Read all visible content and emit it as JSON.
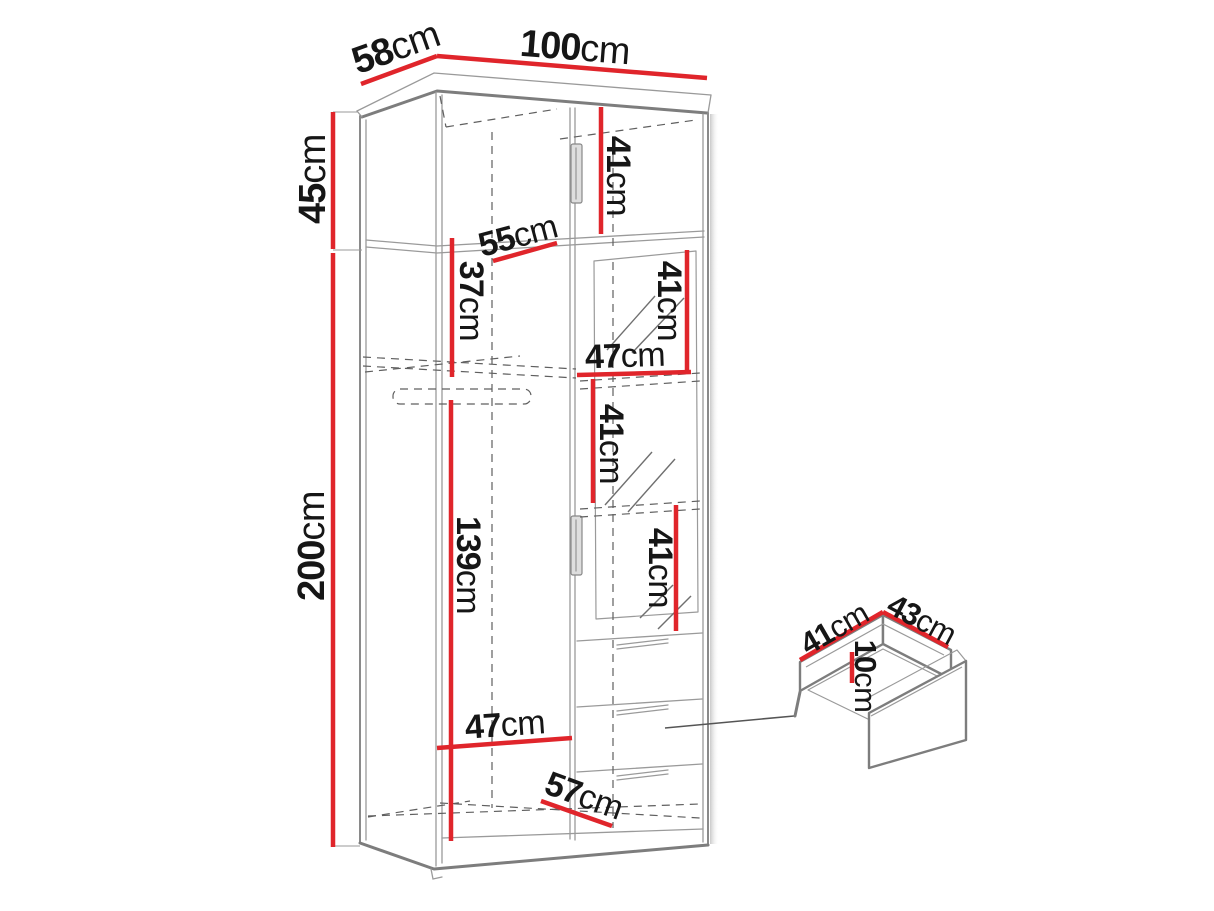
{
  "diagram_title": "wardrobe-dimension-drawing",
  "colors": {
    "dimension_red": "#e0252b",
    "outline_gray": "#7d7d7d",
    "text": "#161616"
  },
  "wardrobe": {
    "top_width": {
      "value": "100",
      "unit": "cm"
    },
    "top_depth": {
      "value": "58",
      "unit": "cm"
    },
    "upper_section_height": {
      "value": "45",
      "unit": "cm"
    },
    "total_height": {
      "value": "200",
      "unit": "cm"
    },
    "upper_compartment_inner": {
      "value": "41",
      "unit": "cm"
    },
    "upper_shelf_depth": {
      "value": "55",
      "unit": "cm"
    },
    "upper_left_inner": {
      "value": "37",
      "unit": "cm"
    },
    "right_shelf_gap_top": {
      "value": "41",
      "unit": "cm"
    },
    "right_section_width": {
      "value": "47",
      "unit": "cm"
    },
    "right_shelf_gap_mid": {
      "value": "41",
      "unit": "cm"
    },
    "right_shelf_gap_low": {
      "value": "41",
      "unit": "cm"
    },
    "hanging_area_height": {
      "value": "139",
      "unit": "cm"
    },
    "left_section_width": {
      "value": "47",
      "unit": "cm"
    },
    "bottom_inner_depth": {
      "value": "57",
      "unit": "cm"
    }
  },
  "drawer_detail": {
    "inner_depth": {
      "value": "41",
      "unit": "cm"
    },
    "inner_width": {
      "value": "43",
      "unit": "cm"
    },
    "inner_height": {
      "value": "10",
      "unit": "cm"
    }
  }
}
